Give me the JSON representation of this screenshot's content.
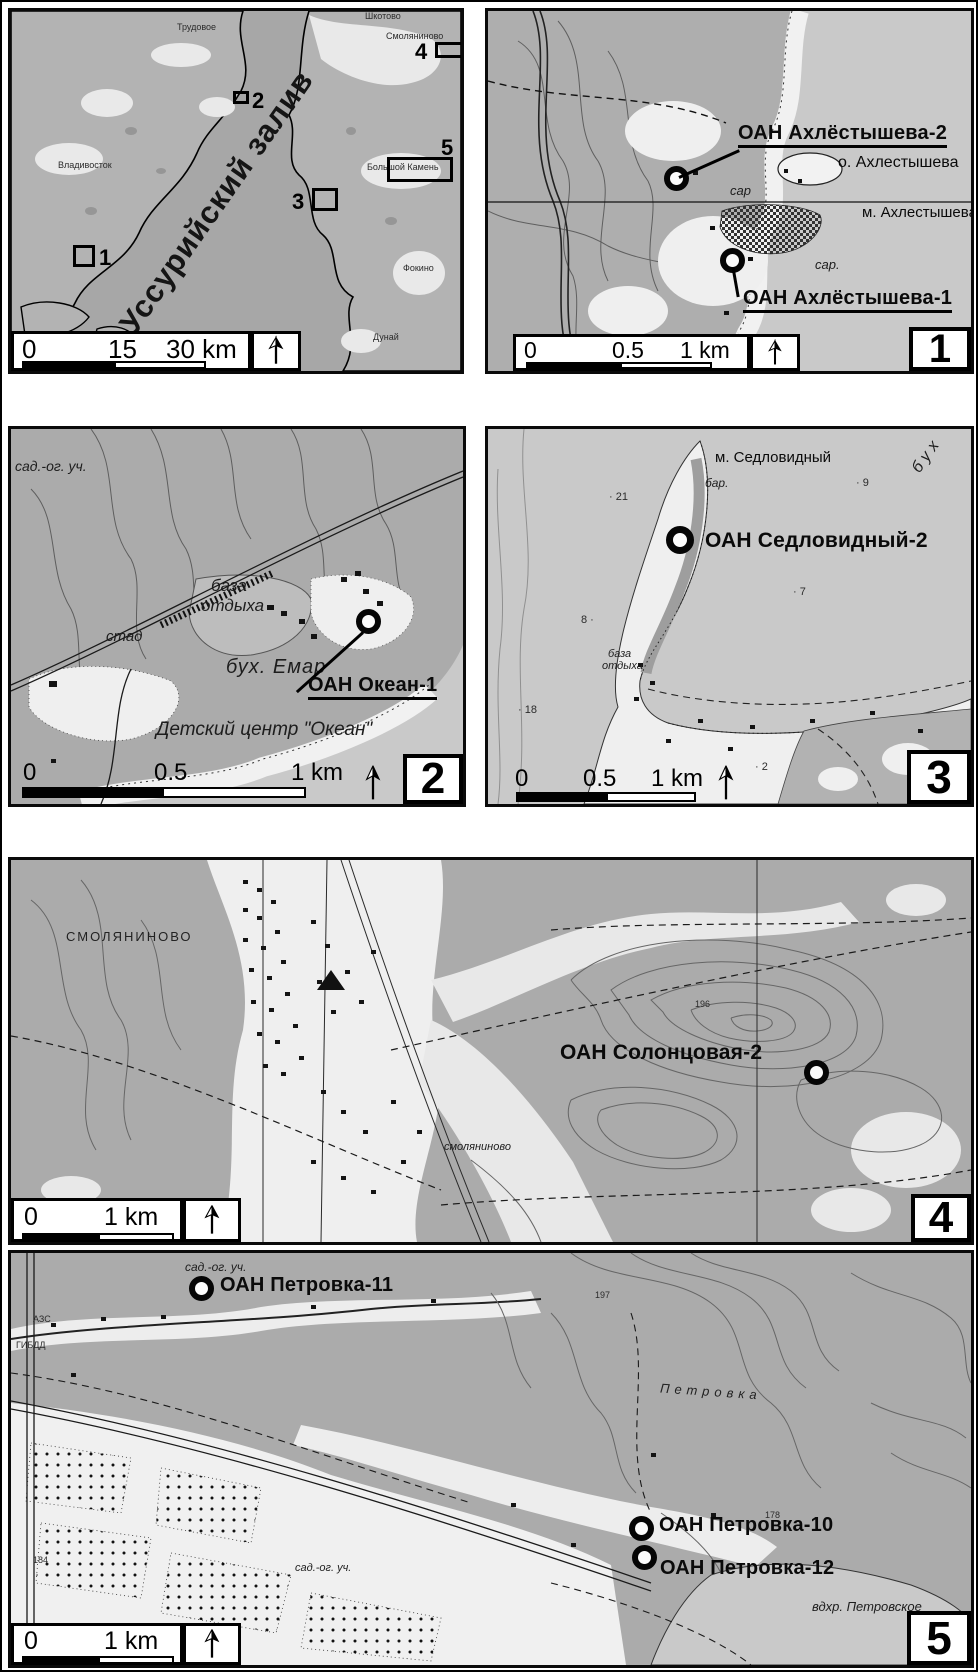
{
  "colors": {
    "land_grey": "#ababab",
    "sea_grey": "#c9c9c9",
    "overview_sea": "#a7a7a7",
    "ink": "#0a0a0a"
  },
  "overview": {
    "bay_label": "Уссурийский залив",
    "towns": {
      "shkotovo": "Шкотово",
      "trudovoe": "Трудовое",
      "smolyaninovo": "Смоляниново",
      "vladivostok": "Владивосток",
      "bolshoy_kamen": "Большой Камень",
      "fokino": "Фокино",
      "dunay": "Дунай"
    },
    "boxes": {
      "b1": "1",
      "b2": "2",
      "b3": "3",
      "b4": "4",
      "b5": "5"
    },
    "scale": {
      "t0": "0",
      "t1": "15",
      "t2": "30 km"
    }
  },
  "p1": {
    "number": "1",
    "site_top": "ОАН Ахлёстышева-2",
    "site_bottom": "ОАН Ахлёстышева-1",
    "island": "о. Ахлестышева",
    "cape": "м. Ахлестышева",
    "shed_a": "сар",
    "shed_b": "сар.",
    "scale": {
      "t0": "0",
      "t1": "0.5",
      "t2": "1 km"
    }
  },
  "p2": {
    "number": "2",
    "site": "ОАН Океан-1",
    "garden": "сад.-ог. уч.",
    "camp_line1": "база",
    "camp_line2": "отдыха",
    "stadium": "стад",
    "bay": "бух. Емар",
    "center": "Детский центр \"Океан\"",
    "scale": {
      "t0": "0",
      "t1": "0.5",
      "t2": "1 km"
    }
  },
  "p3": {
    "number": "3",
    "site": "ОАН Седловидный-2",
    "cape": "м. Седловидный",
    "bar": "бар.",
    "bay": "бух",
    "camp_line1": "база",
    "camp_line2": "отдыха",
    "depth_21": "· 21",
    "depth_9": "· 9",
    "depth_7": "· 7",
    "depth_8": "8 ·",
    "depth_18": "· 18",
    "depth_2": "· 2",
    "scale": {
      "t0": "0",
      "t1": "0.5",
      "t2": "1 km"
    }
  },
  "p4": {
    "number": "4",
    "site": "ОАН Солонцовая-2",
    "town_caps": "СМОЛЯНИНОВО",
    "town_small": "смоляниново",
    "elev_196": "196",
    "scale": {
      "t0": "0",
      "t1": "1 km"
    }
  },
  "p5": {
    "number": "5",
    "site_11": "ОАН Петровка-11",
    "site_10": "ОАН Петровка-10",
    "site_12": "ОАН Петровка-12",
    "reservoir": "вдхр. Петровское",
    "river": "Петровка",
    "garden_top": "сад.-ог. уч.",
    "garden_bottom": "сад.-ог. уч.",
    "gas_station": "АЗС",
    "gibdd": "ГИБДД",
    "elev_197": "197",
    "elev_178": "178",
    "elev_184": "184",
    "scale": {
      "t0": "0",
      "t1": "1 km"
    }
  }
}
